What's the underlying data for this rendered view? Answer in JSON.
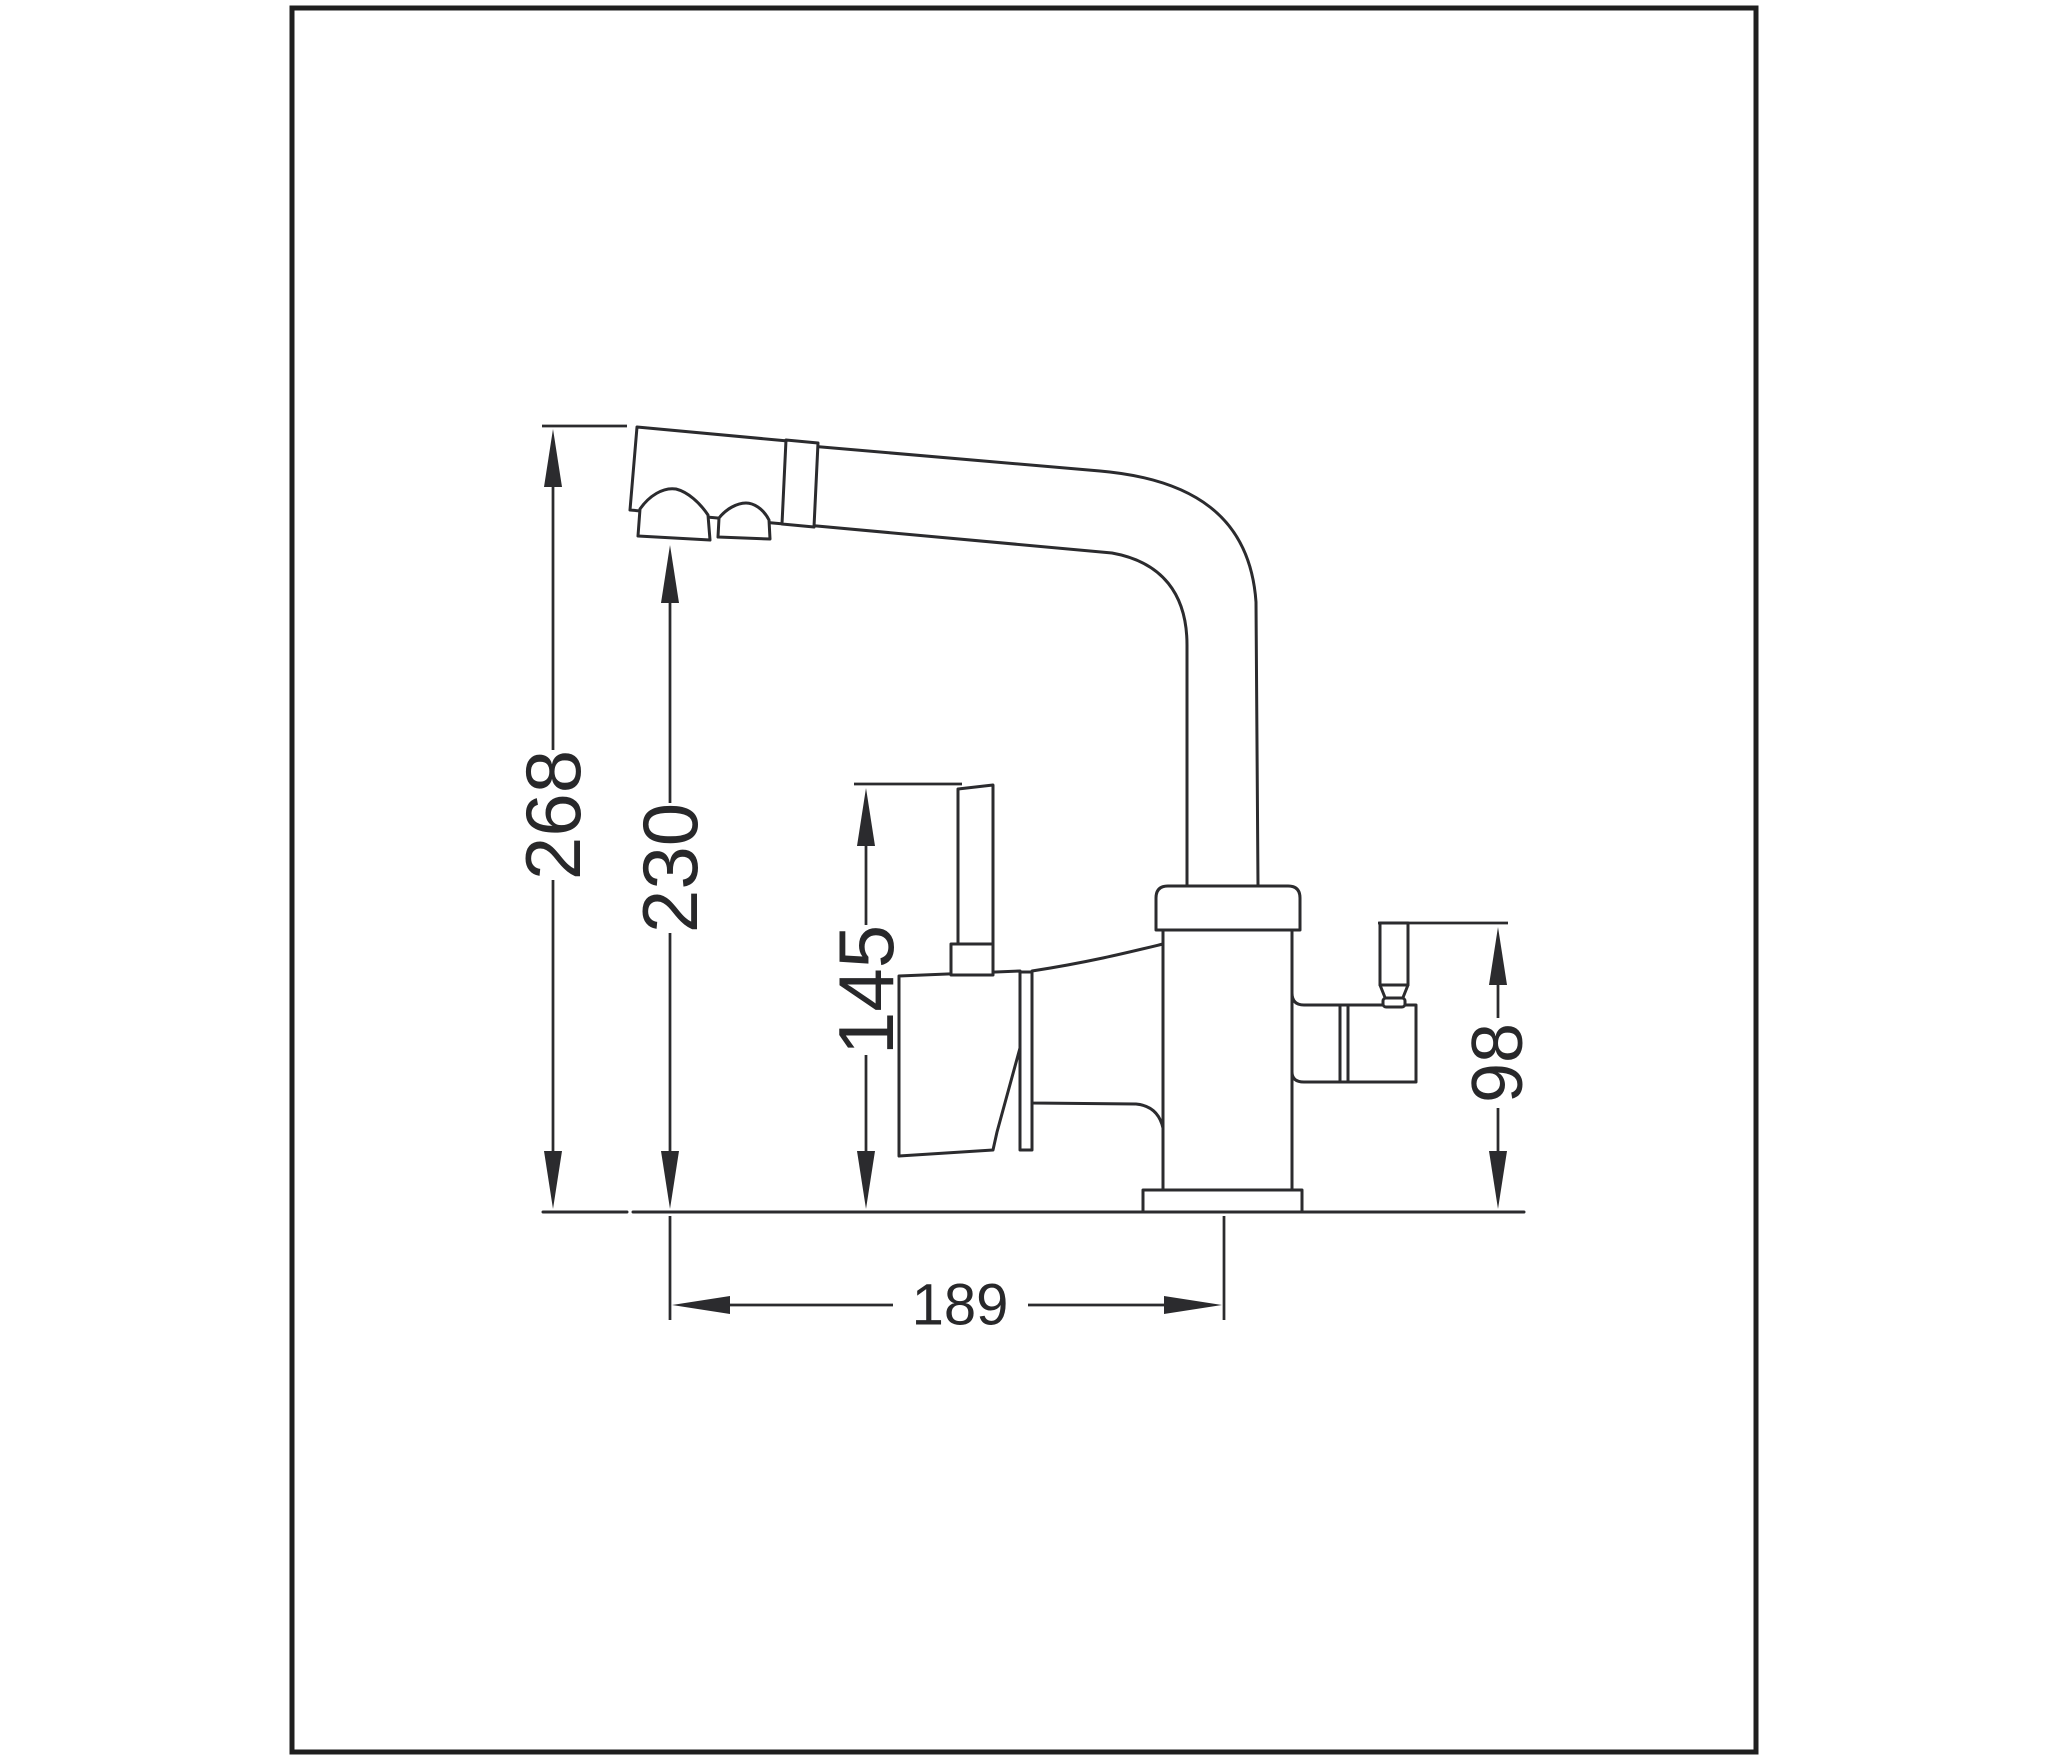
{
  "drawing": {
    "title": "kitchen-faucet-dimension-drawing",
    "units_shown": "none",
    "colors": {
      "line": "#2b2b2e",
      "background": "#ffffff",
      "frame": "#1f1f1f"
    },
    "dimensions": [
      {
        "id": "overall-height",
        "value": "268",
        "orientation": "vertical"
      },
      {
        "id": "spout-outlet-height",
        "value": "230",
        "orientation": "vertical"
      },
      {
        "id": "main-handle-height",
        "value": "145",
        "orientation": "vertical"
      },
      {
        "id": "side-lever-height",
        "value": "98",
        "orientation": "vertical"
      },
      {
        "id": "spout-reach",
        "value": "189",
        "orientation": "horizontal"
      }
    ]
  }
}
